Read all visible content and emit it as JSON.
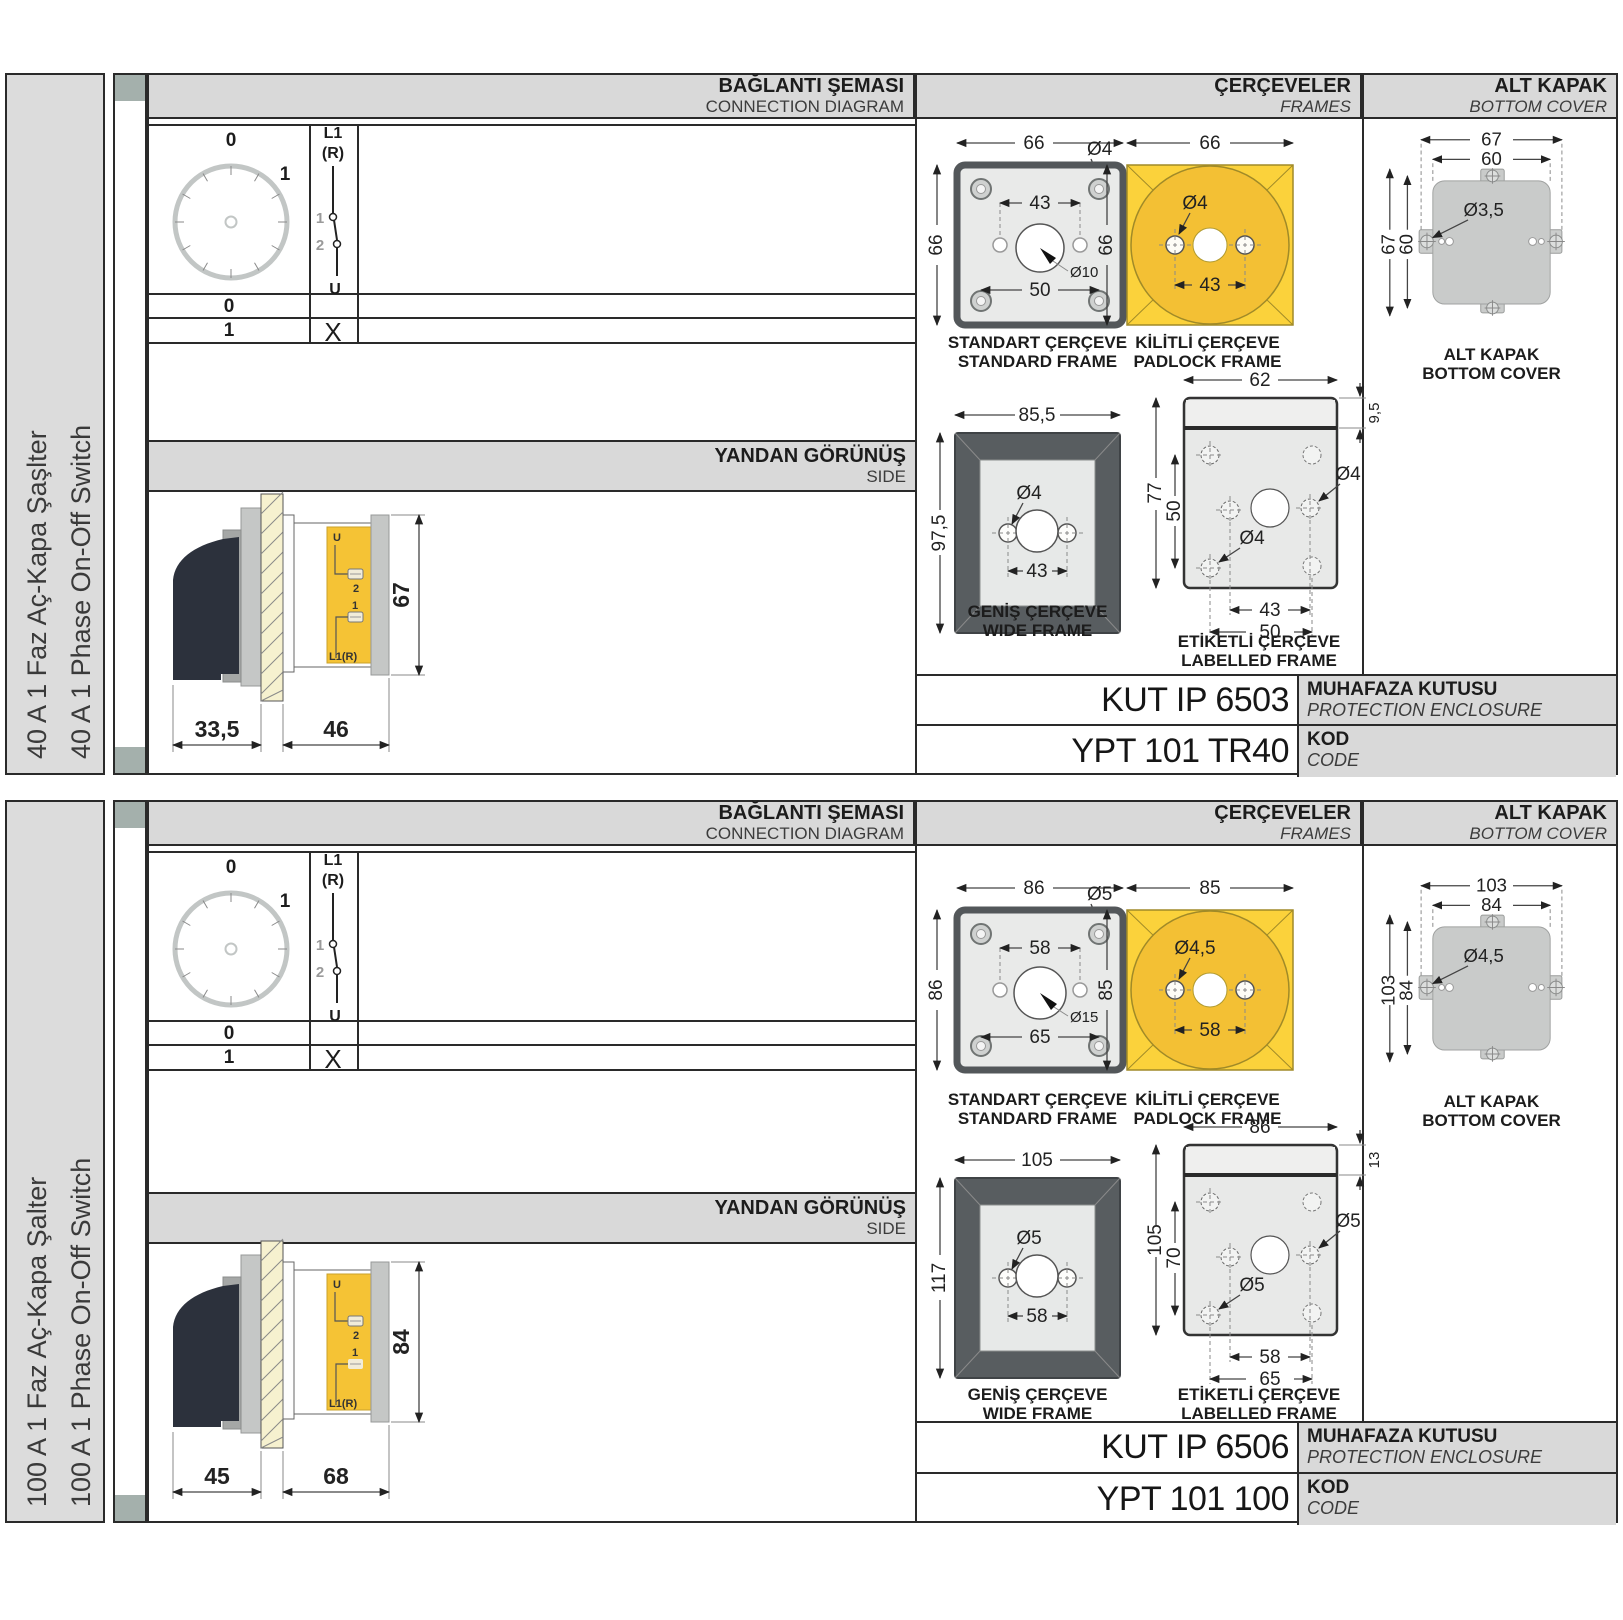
{
  "sections": [
    {
      "label_tr": "40 A 1 Faz Aç-Kapa Şaşlter",
      "label_en": "40 A 1 Phase On-Off Switch",
      "conn": {
        "tr": "BAĞLANTI ŞEMASI",
        "en": "CONNECTION DIAGRAM",
        "pos0": "0",
        "pos1": "1",
        "l1": "L1",
        "r": "(R)",
        "c1": "1",
        "c2": "2",
        "u": "U",
        "row0": "0",
        "row1": "1",
        "x": "X"
      },
      "side": {
        "tr": "YANDAN GÖRÜNÜŞ",
        "en": "SIDE",
        "d_handle": "33,5",
        "d_body": "46",
        "d_height": "67",
        "u": "U",
        "t2": "2",
        "t1": "1",
        "l1r": "L1(R)"
      },
      "frames_hdr": {
        "tr": "ÇERÇEVELER",
        "en": "FRAMES"
      },
      "cover_hdr": {
        "tr": "ALT KAPAK",
        "en": "BOTTOM COVER"
      },
      "std": {
        "tr": "STANDART ÇERÇEVE",
        "en": "STANDARD FRAME",
        "w": "66",
        "h": "66",
        "hole": "Ø4",
        "inner": "43",
        "center": "Ø10",
        "outer": "50"
      },
      "pad": {
        "tr": "KİLİTLİ ÇERÇEVE",
        "en": "PADLOCK FRAME",
        "w": "66",
        "h": "66",
        "hole": "Ø4",
        "inner": "43"
      },
      "wide": {
        "tr": "GENİŞ ÇERÇEVE",
        "en": "WIDE FRAME",
        "w": "85,5",
        "h": "97,5",
        "hole": "Ø4",
        "inner": "43"
      },
      "lab": {
        "tr": "ETİKETLİ ÇERÇEVE",
        "en": "LABELLED FRAME",
        "w": "62",
        "strip": "9,5",
        "h": "77",
        "innerv": "50",
        "hole1": "Ø4",
        "hole2": "Ø4",
        "inner": "43",
        "outer": "50"
      },
      "cover": {
        "cap_tr": "ALT KAPAK",
        "cap_en": "BOTTOM COVER",
        "w1": "67",
        "w2": "60",
        "h1": "67",
        "h2": "60",
        "hole": "Ø3,5"
      },
      "codes": {
        "enc": "KUT IP 6503",
        "enc_tr": "MUHAFAZA KUTUSU",
        "enc_en": "PROTECTION ENCLOSURE",
        "kod": "YPT 101 TR40",
        "kod_tr": "KOD",
        "kod_en": "CODE"
      }
    },
    {
      "label_tr": "100 A 1 Faz Aç-Kapa Şalter",
      "label_en": "100 A 1 Phase On-Off Switch",
      "conn": {
        "tr": "BAĞLANTI ŞEMASI",
        "en": "CONNECTION DIAGRAM",
        "pos0": "0",
        "pos1": "1",
        "l1": "L1",
        "r": "(R)",
        "c1": "1",
        "c2": "2",
        "u": "U",
        "row0": "0",
        "row1": "1",
        "x": "X"
      },
      "side": {
        "tr": "YANDAN GÖRÜNÜŞ",
        "en": "SIDE",
        "d_handle": "45",
        "d_body": "68",
        "d_height": "84",
        "u": "U",
        "t2": "2",
        "t1": "1",
        "l1r": "L1(R)"
      },
      "frames_hdr": {
        "tr": "ÇERÇEVELER",
        "en": "FRAMES"
      },
      "cover_hdr": {
        "tr": "ALT KAPAK",
        "en": "BOTTOM COVER"
      },
      "std": {
        "tr": "STANDART ÇERÇEVE",
        "en": "STANDARD FRAME",
        "w": "86",
        "h": "86",
        "hole": "Ø5",
        "inner": "58",
        "center": "Ø15",
        "outer": "65"
      },
      "pad": {
        "tr": "KİLİTLİ ÇERÇEVE",
        "en": "PADLOCK FRAME",
        "w": "85",
        "h": "85",
        "hole": "Ø4,5",
        "inner": "58"
      },
      "wide": {
        "tr": "GENİŞ ÇERÇEVE",
        "en": "WIDE FRAME",
        "w": "105",
        "h": "117",
        "hole": "Ø5",
        "inner": "58"
      },
      "lab": {
        "tr": "ETİKETLİ ÇERÇEVE",
        "en": "LABELLED FRAME",
        "w": "86",
        "strip": "13",
        "h": "105",
        "innerv": "70",
        "hole1": "Ø5",
        "hole2": "Ø5",
        "inner": "58",
        "outer": "65"
      },
      "cover": {
        "cap_tr": "ALT KAPAK",
        "cap_en": "BOTTOM COVER",
        "w1": "103",
        "w2": "84",
        "h1": "103",
        "h2": "84",
        "hole": "Ø4,5"
      },
      "codes": {
        "enc": "KUT IP 6506",
        "enc_tr": "MUHAFAZA KUTUSU",
        "enc_en": "PROTECTION ENCLOSURE",
        "kod": "YPT 101 100",
        "kod_tr": "KOD",
        "kod_en": "CODE"
      }
    }
  ]
}
